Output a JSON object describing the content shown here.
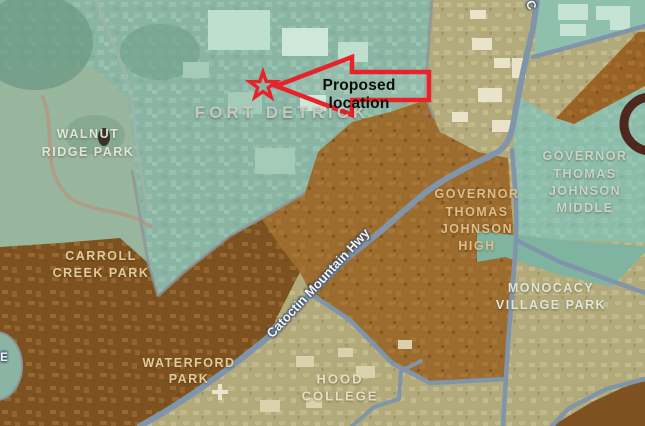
{
  "map": {
    "annotation": {
      "text": "Proposed location",
      "marker": "star-icon",
      "accent_color": "#e8212a"
    },
    "labels": {
      "walnut": {
        "line1": "WALNUT",
        "line2": "RIDGE PARK"
      },
      "fort_detrick": {
        "line1": "FORT DETRICK"
      },
      "carroll": {
        "line1": "CARROLL",
        "line2": "CREEK PARK"
      },
      "waterford": {
        "line1": "WATERFORD",
        "line2": "PARK"
      },
      "hood": {
        "line1": "HOOD",
        "line2": "COLLEGE"
      },
      "gtj_high": {
        "line1": "GOVERNOR",
        "line2": "THOMAS",
        "line3": "JOHNSON",
        "line4": "HIGH"
      },
      "gtj_middle": {
        "line1": "GOVERNOR",
        "line2": "THOMAS",
        "line3": "JOHNSON",
        "line4": "MIDDLE"
      },
      "monocacy": {
        "line1": "MONOCACY",
        "line2": "VILLAGE PARK"
      }
    },
    "roads": {
      "catoctin_hwy": "Catoctin Mountain Hwy",
      "partial_top": "C",
      "partial_left": "E"
    },
    "colors": {
      "teal_region": "#8ab4a3",
      "teal_bright": "#8ec2af",
      "walnut_green": "#99b59d",
      "dark_brown": "#7e5220",
      "medium_brown": "#9c6b2e",
      "olive": "#b2aa7b",
      "road_blue": "#8095aa",
      "maroon_ring": "#451209",
      "annotation_red": "#e8212a"
    }
  }
}
